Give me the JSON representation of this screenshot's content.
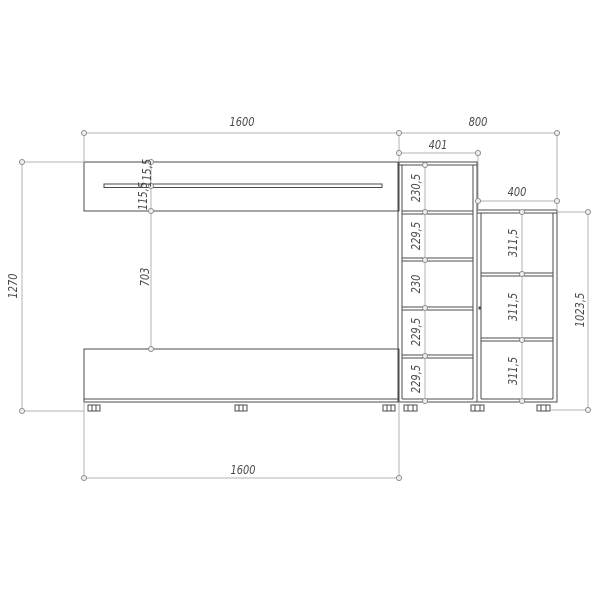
{
  "drawing": {
    "type": "furniture-dimension-drawing",
    "labels": {
      "top_left_width": "1600",
      "top_right_width": "800",
      "column_width": "401",
      "right_unit_width": "400",
      "overall_height": "1270",
      "shelf_gap_top": "115,5",
      "shelf_gap_bottom": "115,5",
      "middle_gap": "703",
      "bottom_width": "1600",
      "right_unit_height": "1023,5",
      "column_cells": [
        "230,5",
        "229,5",
        "230",
        "229,5",
        "229,5"
      ],
      "right_unit_cells": [
        "311,5",
        "311,5",
        "311,5"
      ]
    },
    "colors": {
      "outline": "#4b4b4b",
      "dim": "#b3b3b3",
      "marker": "#8c8c8c",
      "text": "#4a4a4a",
      "background": "#ffffff"
    }
  }
}
